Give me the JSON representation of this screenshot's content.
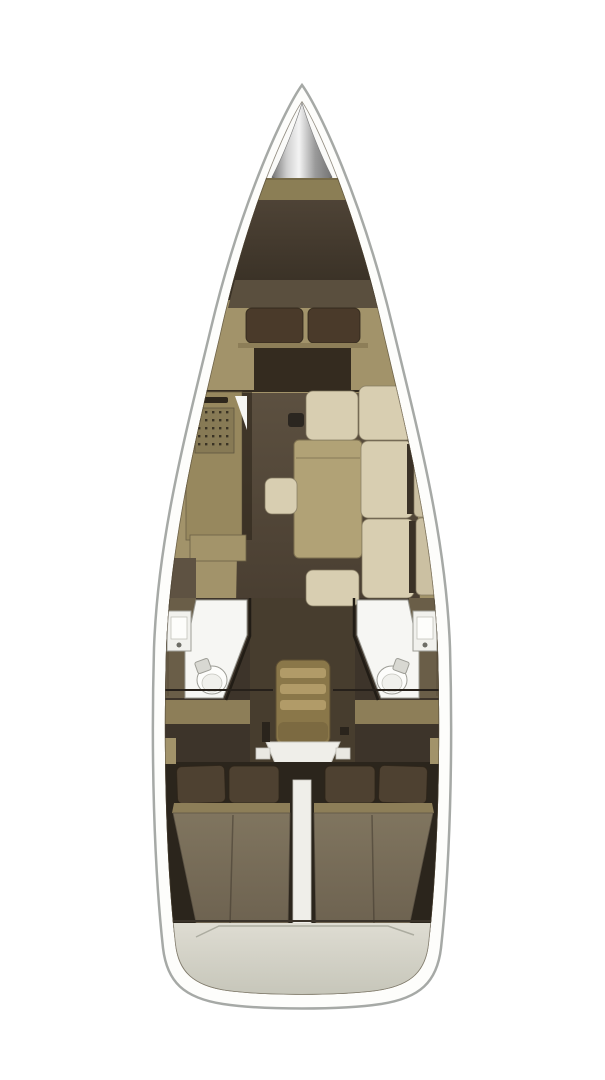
{
  "meta": {
    "title": "Sailing yacht interior layout — top-down floor plan",
    "type": "yacht-floor-plan"
  },
  "regions": {
    "bow": "anchor-locker",
    "forward": "forward-cabin-v-berth",
    "port_mid": "galley",
    "center_mid": "salon-table",
    "starboard_mid": "l-shaped-settee",
    "port_head": "port-bathroom",
    "starboard_head": "starboard-bathroom",
    "center": "companionway-stairs",
    "port_aft": "port-aft-double-cabin",
    "starboard_aft": "starboard-aft-double-cabin",
    "stern": "transom"
  },
  "palette": {
    "pageBg": "#ffffff",
    "hullFill": "#fdfdfb",
    "hullStroke": "#a6a9a6",
    "bowBg": "#fafaf8",
    "coneEdge": "#737373",
    "coneMid": "#cfcfcf",
    "coneLight": "#f4f4f4",
    "coneShade": "#9a9a9a",
    "wood": "#a2936a",
    "wood2": "#8d7e58",
    "bulkhead": "#8b7e55",
    "forepeakTop": "#4e4336",
    "forepeakBottom": "#362e23",
    "berthHead": "#5a4f3e",
    "pillowFwd": "#4a3a2a",
    "pillowAft": "#4e4131",
    "fwdBedDark": "#342b1f",
    "floorTop": "#5c5040",
    "floorBottom": "#493e31",
    "galley": "#97885e",
    "galley2": "#a3946a",
    "galleyShadow": "#2a2318",
    "grillDot": "#3a3324",
    "handle": "#2e271c",
    "doorWhite": "#f6f6f3",
    "darkItem": "#2b2620",
    "table": "#b1a276",
    "cream": "#d8ceb1",
    "cream2": "#cbc0a2",
    "gapDark": "#3a3126",
    "headsBg": "#3d342a",
    "headsCenter": "#473d2e",
    "sidePanel": "#6a5e48",
    "shower": "#f6f6f3",
    "toilet": "#fdfdfb",
    "toiletInner": "#f0f0ec",
    "sinkOuter": "#f1f1ed",
    "sinkInner": "#fdfdfb",
    "tank": "#d8d8d2",
    "railDark": "#26201a",
    "stairs": "#8a7749",
    "stairsTread": "#b19b68",
    "stairsBase": "#7c6a41",
    "white2": "#efeee9",
    "tabWhite": "#e9e8e2",
    "markDark": "#2a241c",
    "aftBg": "#2b251c",
    "duvetTop": "#80755f",
    "duvetBottom": "#6d6250",
    "transomTop": "#dedcd2",
    "transomBottom": "#bfbfb2",
    "seam": "#acaca0",
    "darkPatch": "#5e5242"
  }
}
